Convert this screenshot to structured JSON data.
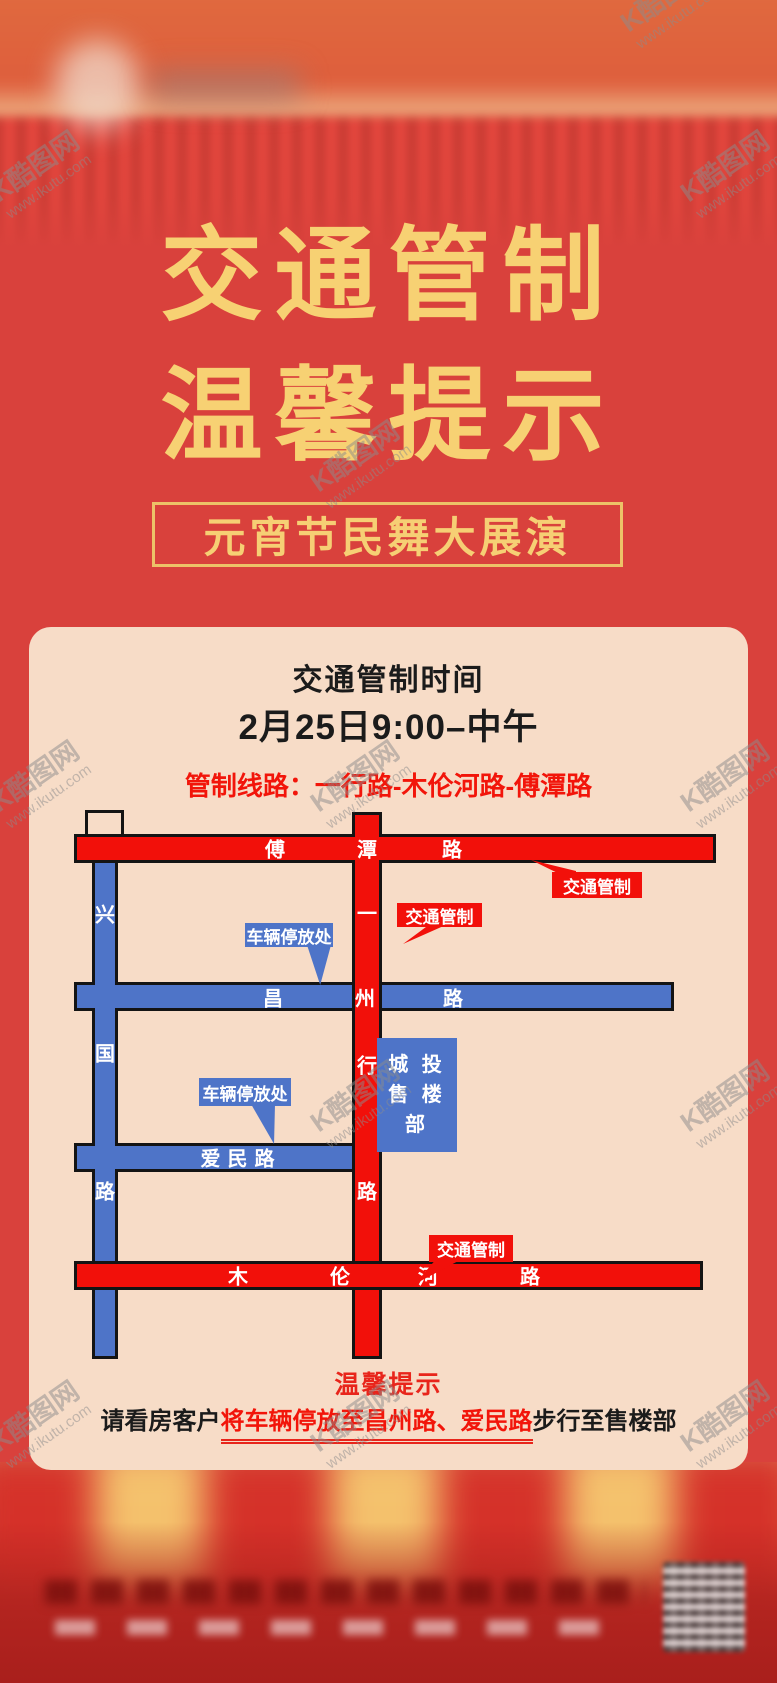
{
  "title": {
    "line1": "交通管制",
    "line2": "温馨提示"
  },
  "banner": "元宵节民舞大展演",
  "panel": {
    "heading": "交通管制时间",
    "time": "2月25日9:00–中午",
    "route": "管制线路：一行路-木伦河路-傅潭路",
    "map": {
      "roads": {
        "futan": {
          "name": "傅潭路",
          "chars": [
            "傅",
            "潭",
            "路"
          ]
        },
        "yixing": {
          "name": "一行路",
          "chars": [
            "一",
            "行",
            "路"
          ]
        },
        "xingguo": {
          "name": "兴国路",
          "chars": [
            "兴",
            "国",
            "路"
          ]
        },
        "changzhou": {
          "name": "昌州路",
          "chars": [
            "昌",
            "州",
            "路"
          ]
        },
        "aimin": {
          "name": "爱民路"
        },
        "mulunhe": {
          "name": "木伦河路",
          "chars": [
            "木",
            "伦",
            "河",
            "路"
          ]
        }
      },
      "labels": {
        "traffic_control": "交通管制",
        "parking": "车辆停放处",
        "sales_office_line1": "城 投",
        "sales_office_line2": "售 楼 部"
      }
    },
    "notice": {
      "heading": "温馨提示",
      "prefix": "请看房客户",
      "highlight": "将车辆停放至昌州路、爱民路",
      "suffix": "步行至售楼部"
    }
  },
  "watermark": {
    "logo": "K酷图网",
    "url": "www.ikutu.com"
  },
  "colors": {
    "background_red": "#D9413C",
    "panel_beige": "#F7DCC7",
    "road_red": "#F2100A",
    "road_blue": "#4E74C8",
    "title_gold": "#F7D173",
    "notice_red": "#E8251B"
  }
}
